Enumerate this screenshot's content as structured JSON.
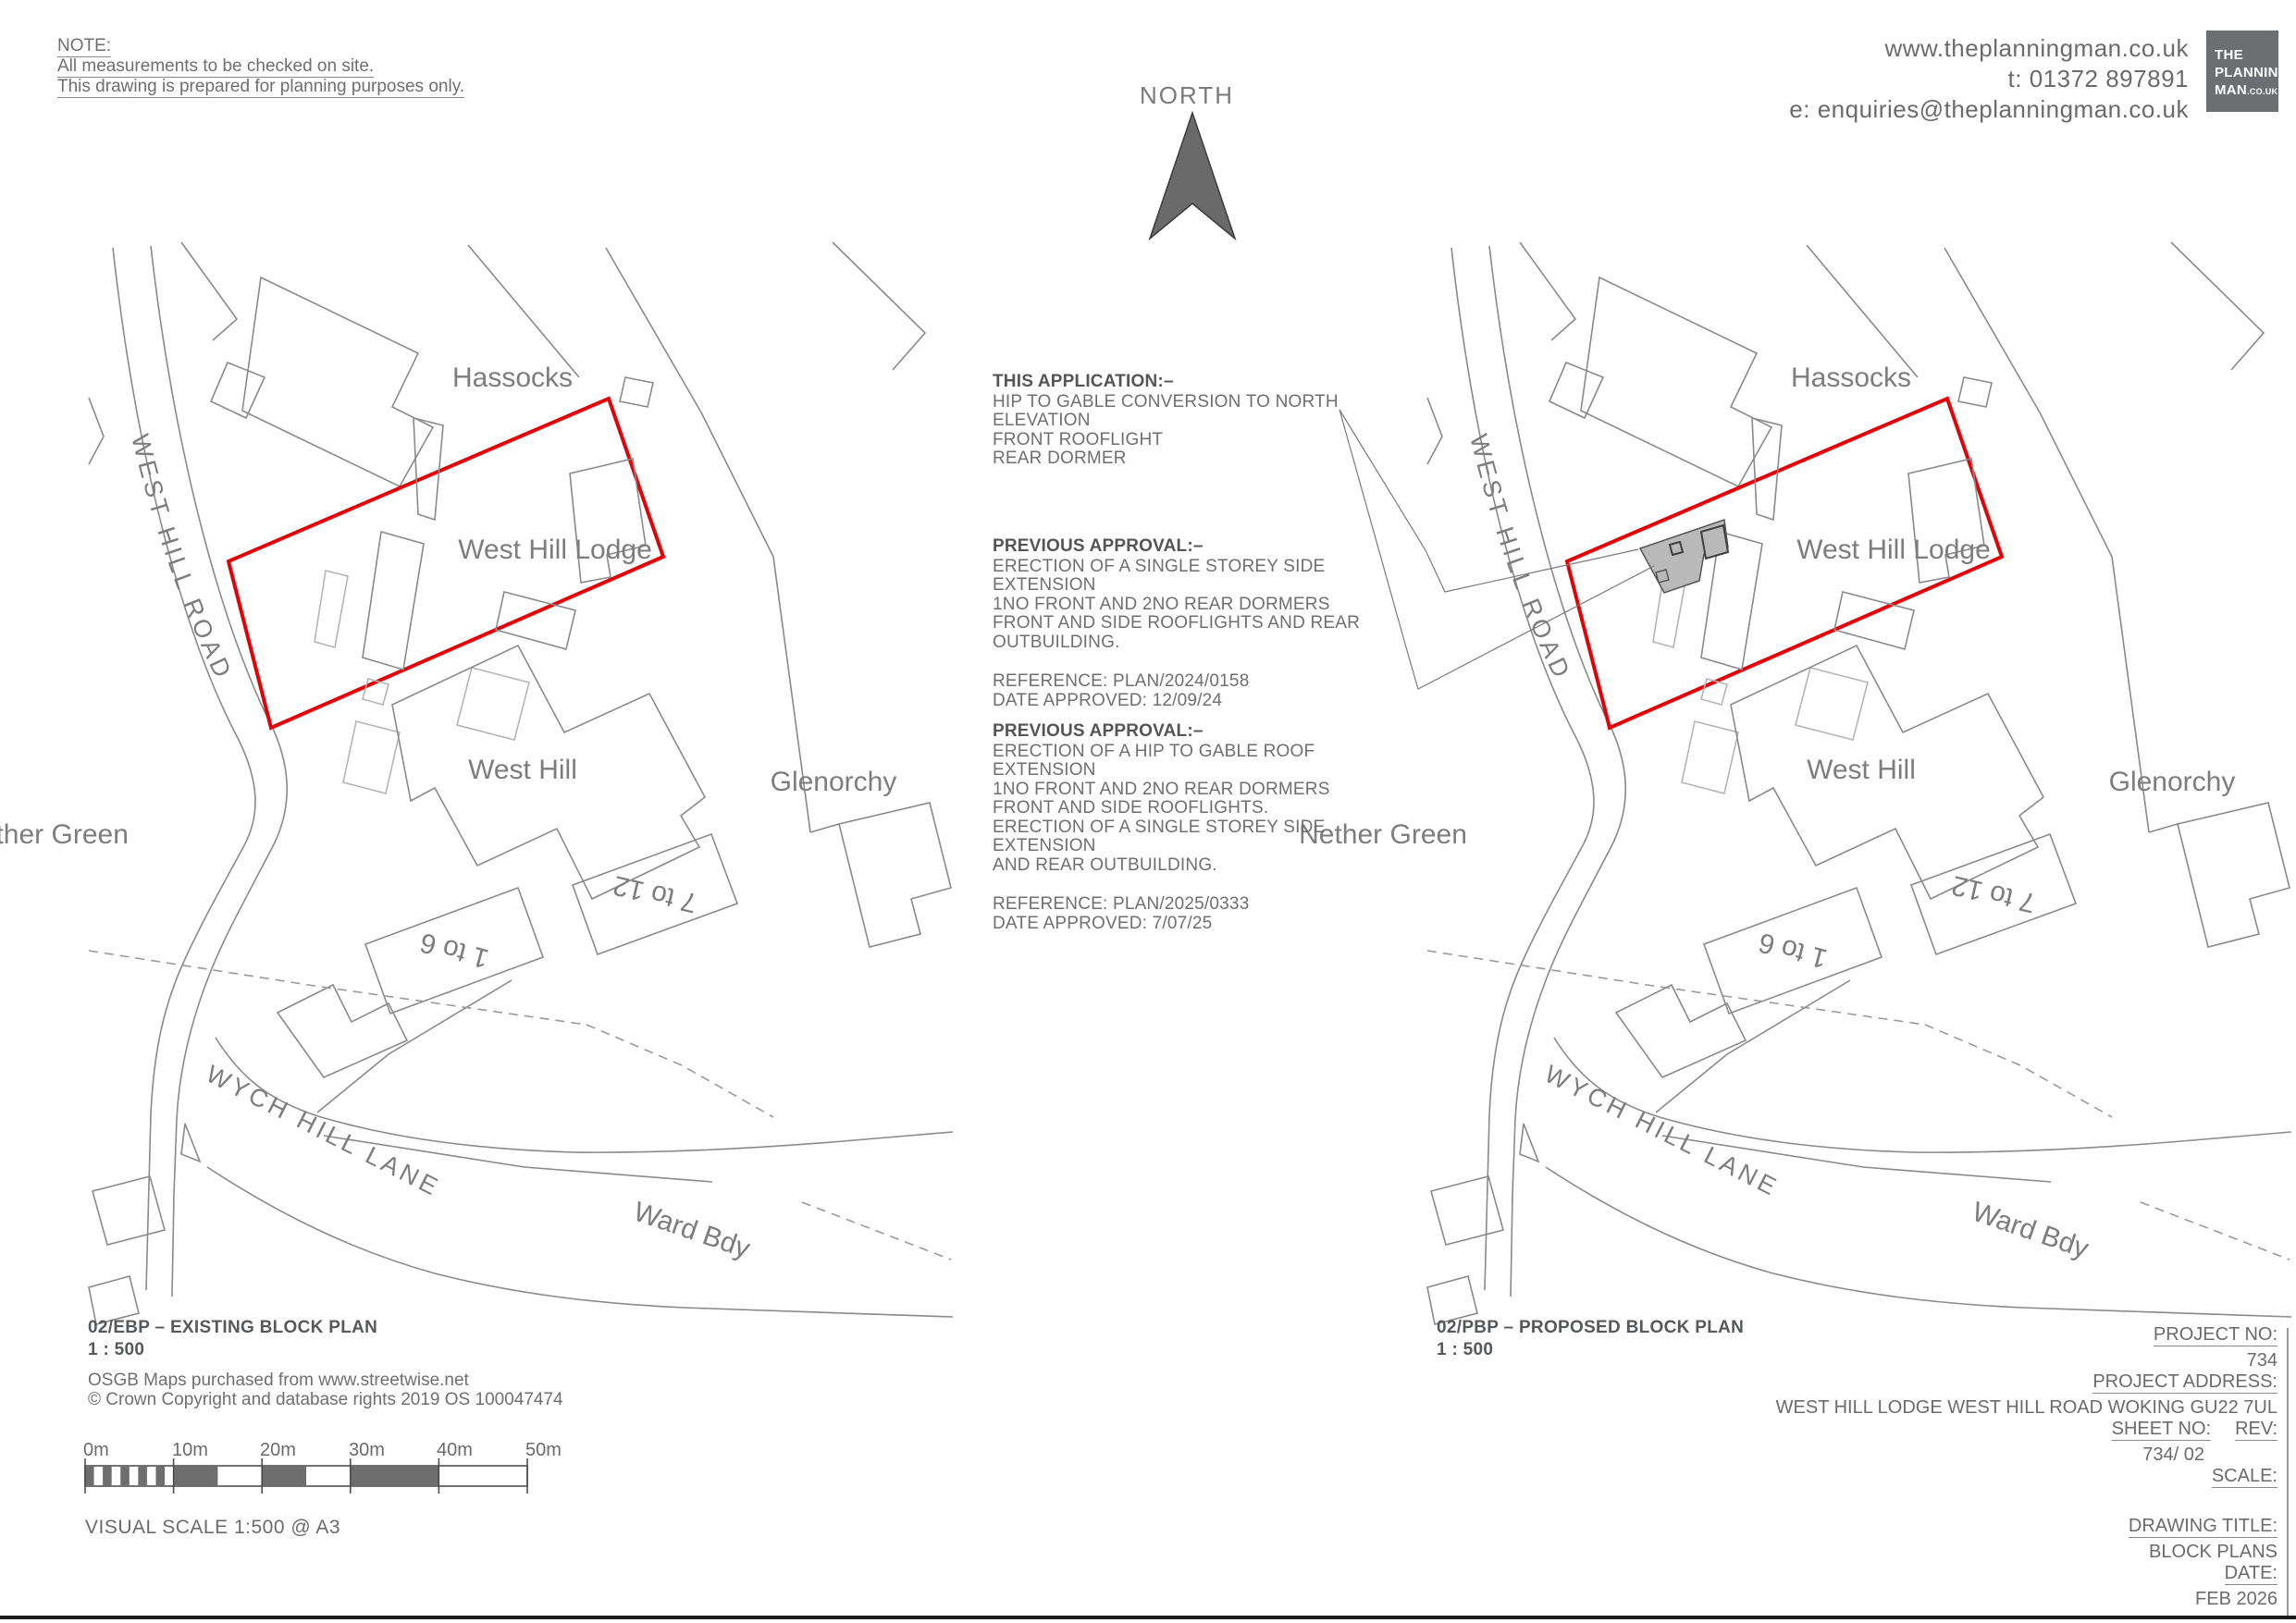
{
  "note": {
    "title": "NOTE:",
    "line1": "All measurements to be checked on site.",
    "line2": "This drawing is prepared for planning purposes only."
  },
  "contact": {
    "website": "www.theplanningman.co.uk",
    "phone": "t: 01372 897891",
    "email": "e: enquiries@theplanningman.co.uk"
  },
  "logo": {
    "line1": "THE",
    "line2": "PLANNING",
    "line3": "MAN",
    "line3_suffix": ".CO.UK"
  },
  "north": {
    "label": "NORTH"
  },
  "annotations": {
    "application": {
      "title": "THIS APPLICATION:–",
      "lines": [
        "HIP TO GABLE CONVERSION TO NORTH ELEVATION",
        "FRONT ROOFLIGHT",
        "REAR DORMER"
      ]
    },
    "approval1": {
      "title": "PREVIOUS APPROVAL:–",
      "lines": [
        "ERECTION OF A SINGLE STOREY SIDE EXTENSION",
        "1NO FRONT AND 2NO REAR DORMERS",
        "FRONT AND SIDE ROOFLIGHTS AND REAR OUTBUILDING."
      ],
      "reference": "REFERENCE: PLAN/2024/0158",
      "approved": "DATE APPROVED: 12/09/24"
    },
    "approval2": {
      "title": "PREVIOUS APPROVAL:–",
      "lines": [
        "ERECTION OF A HIP TO GABLE ROOF EXTENSION",
        "1NO FRONT AND 2NO REAR DORMERS",
        "FRONT AND SIDE ROOFLIGHTS.",
        "ERECTION OF A SINGLE STOREY SIDE EXTENSION",
        "AND REAR OUTBUILDING."
      ],
      "reference": "REFERENCE: PLAN/2025/0333",
      "approved": "DATE APPROVED: 7/07/25"
    }
  },
  "map_labels": {
    "hassocks": "Hassocks",
    "west_hill_lodge": "West Hill Lodge",
    "west_hill_road": "WEST HILL ROAD",
    "west_hill": "West Hill",
    "glenorchy": "Glenorchy",
    "nether_green": "Nether Green",
    "block_1_to_6": "1 to 6",
    "block_7_to_12": "7 to 12",
    "wych_hill_lane": "WYCH HILL LANE",
    "ward_bdy": "Ward Bdy"
  },
  "captions": {
    "existing": {
      "code": "02/EBP – EXISTING BLOCK PLAN",
      "scale": "1 : 500"
    },
    "proposed": {
      "code": "02/PBP – PROPOSED BLOCK PLAN",
      "scale": "1 : 500"
    }
  },
  "credit": {
    "line1": "OSGB Maps purchased from www.streetwise.net",
    "line2": "© Crown Copyright and database rights 2019 OS 100047474"
  },
  "scale_bar": {
    "labels": [
      "0m",
      "10m",
      "20m",
      "30m",
      "40m",
      "50m"
    ],
    "caption": "VISUAL SCALE 1:500  @ A3"
  },
  "title_block": {
    "project_no_label": "PROJECT NO:",
    "project_no": "734",
    "address_label": "PROJECT ADDRESS:",
    "address": "WEST HILL LODGE WEST HILL ROAD WOKING GU22 7UL",
    "sheet_label": "SHEET NO:",
    "rev_label": "REV:",
    "sheet_no": "734/ 02",
    "scale_label": "SCALE:",
    "drawing_title_label": "DRAWING TITLE:",
    "drawing_title": "BLOCK PLANS",
    "date_label": "DATE:",
    "date": "FEB 2026"
  },
  "colors": {
    "red_boundary": "#e60006",
    "map_line": "#8a8a8a",
    "proposed_fill": "#b9b9b9",
    "north_fill": "#6a6a6a",
    "logo_bg": "#6d6e71"
  }
}
